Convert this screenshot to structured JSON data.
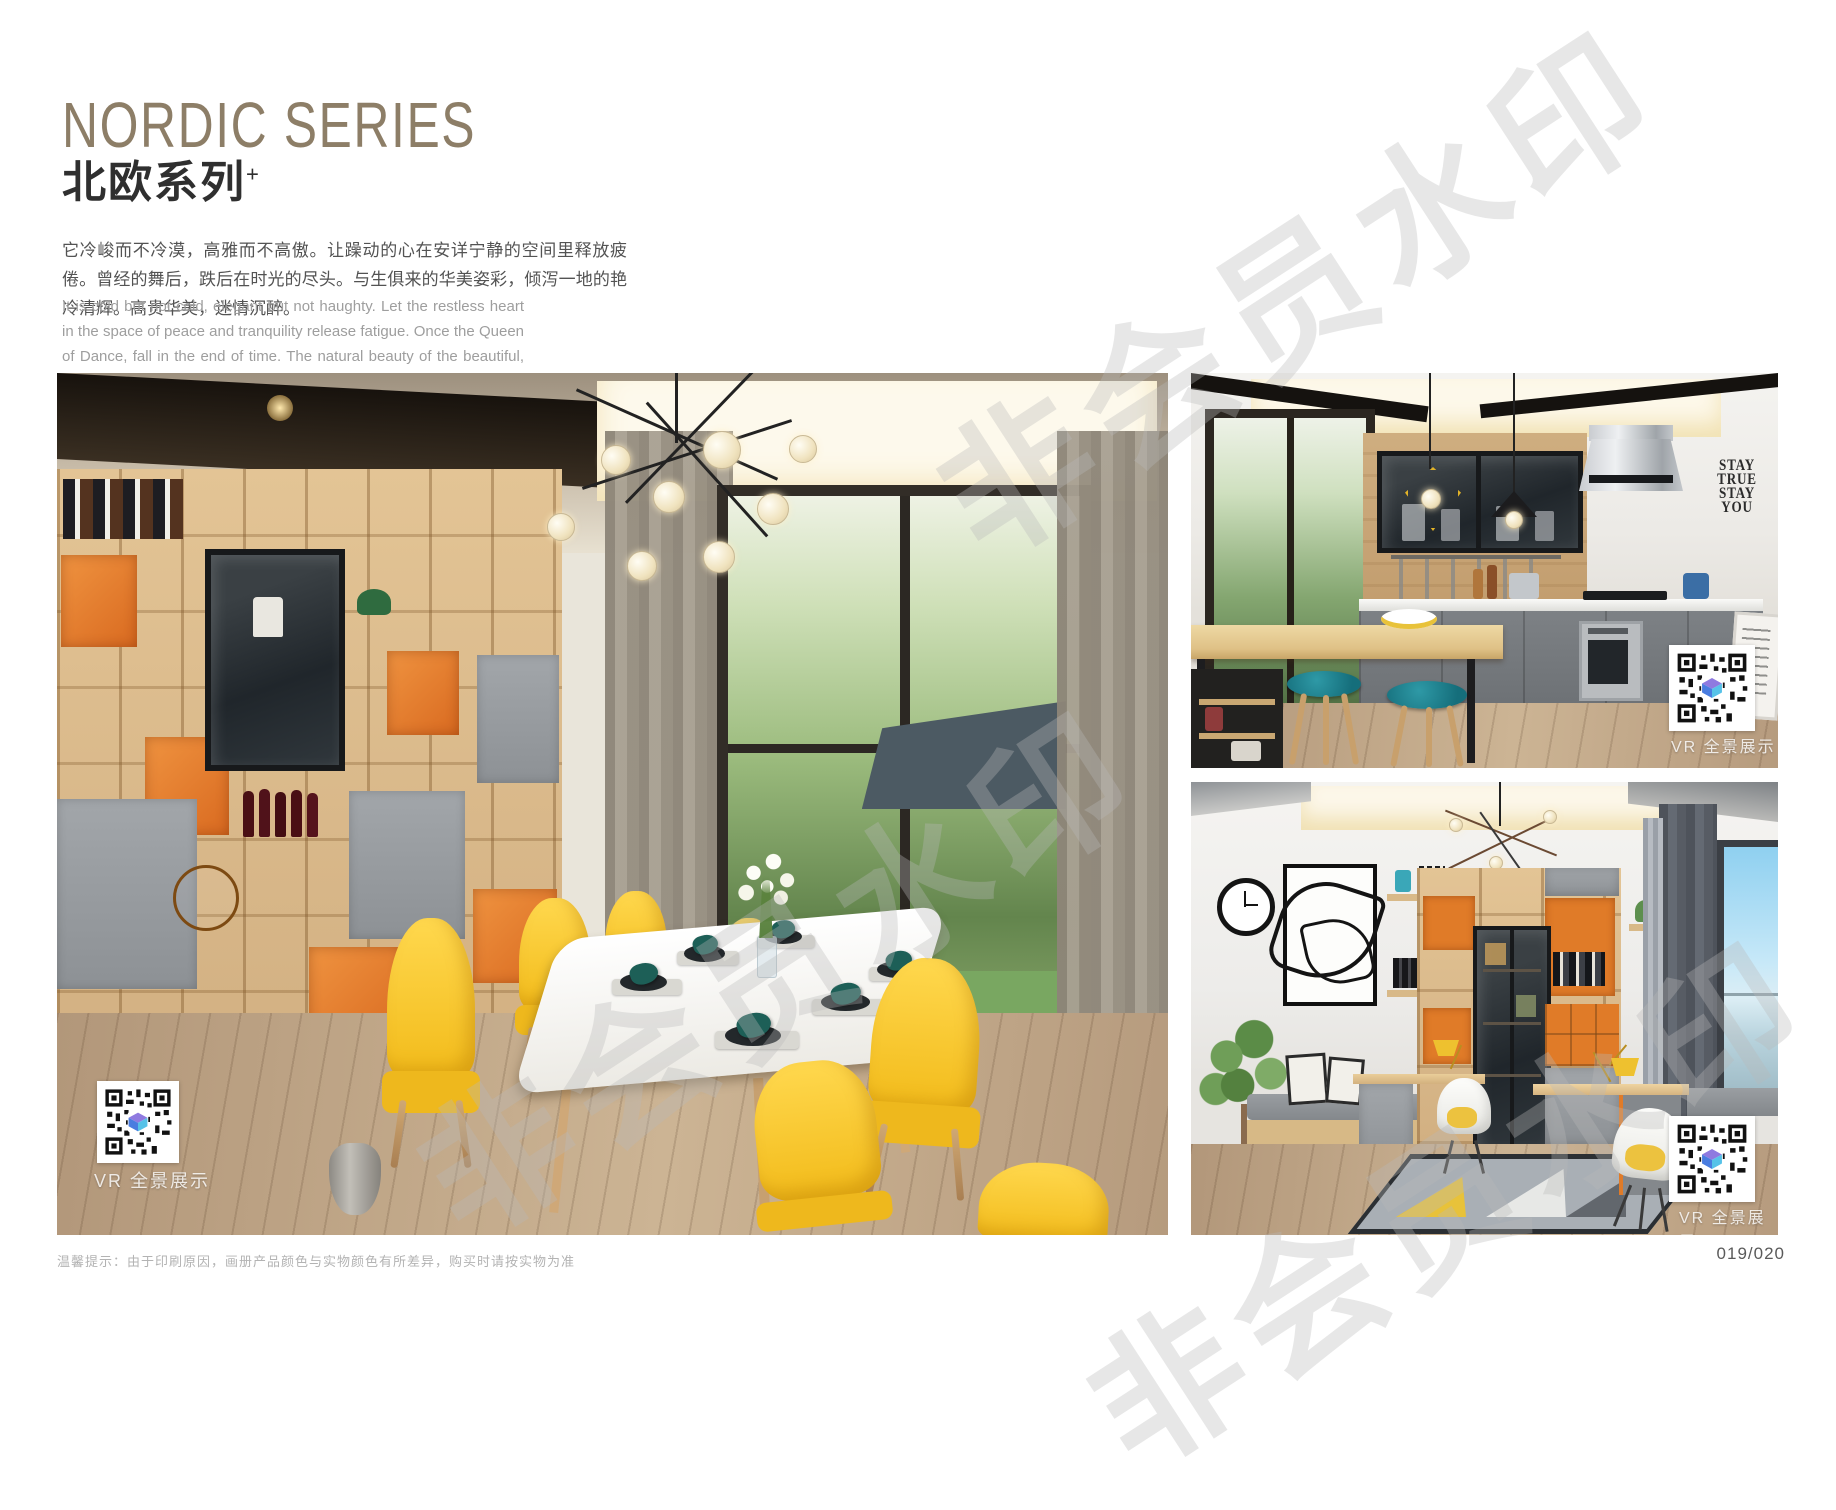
{
  "header": {
    "title": "NORDIC SERIES",
    "subtitle_cn": "北欧系列",
    "subtitle_sup": "+",
    "paragraph_cn": "它冷峻而不冷漠，高雅而不高傲。让躁动的心在安详宁静的空间里释放疲倦。曾经的舞后，跌后在时光的尽头。与生俱来的华美姿彩，倾泻一地的艳冷清辉。高贵华美，迷情沉醉。",
    "paragraph_en": "It is cold but not cold, elegant but not haughty. Let the restless heart in the space of peace and tranquility release fatigue. Once the Queen of Dance, fall in the end of time. The natural beauty of the beautiful, pouring a land of cold and pure brilliance. Noble, beautiful, enchanted."
  },
  "watermark": {
    "text": "非会员水印"
  },
  "photos": {
    "dining": {
      "description": "Nordic dining room with maple shelving wall, orange cubbies, yellow armchairs, white dining table, floor-to-ceiling window",
      "vr_label": "VR 全景展示"
    },
    "kitchen": {
      "description": "Nordic kitchen with island bar, teal stools, grey cabinets, stainless hood",
      "vr_label": "VR 全景展示",
      "wall_decal": [
        "STAY",
        "TRUE",
        "STAY",
        "YOU"
      ]
    },
    "study": {
      "description": "Nordic study with desk units, glass display cabinet, white shell chairs, geometric rug",
      "vr_label": "VR 全景展示"
    }
  },
  "footer": {
    "note": "温馨提示：由于印刷原因，画册产品颜色与实物颜色有所差异，购买时请按实物为准",
    "page_number": "019/020"
  },
  "colors": {
    "title": "#8d7e67",
    "chair_yellow": "#f5c31e",
    "stool_teal": "#1f7f8c",
    "cabinet_orange": "#e07b28",
    "napkin_teal": "#1d5f57",
    "qr_logo_blue": "#4a7de0",
    "watermark_gray": "#bababa"
  }
}
